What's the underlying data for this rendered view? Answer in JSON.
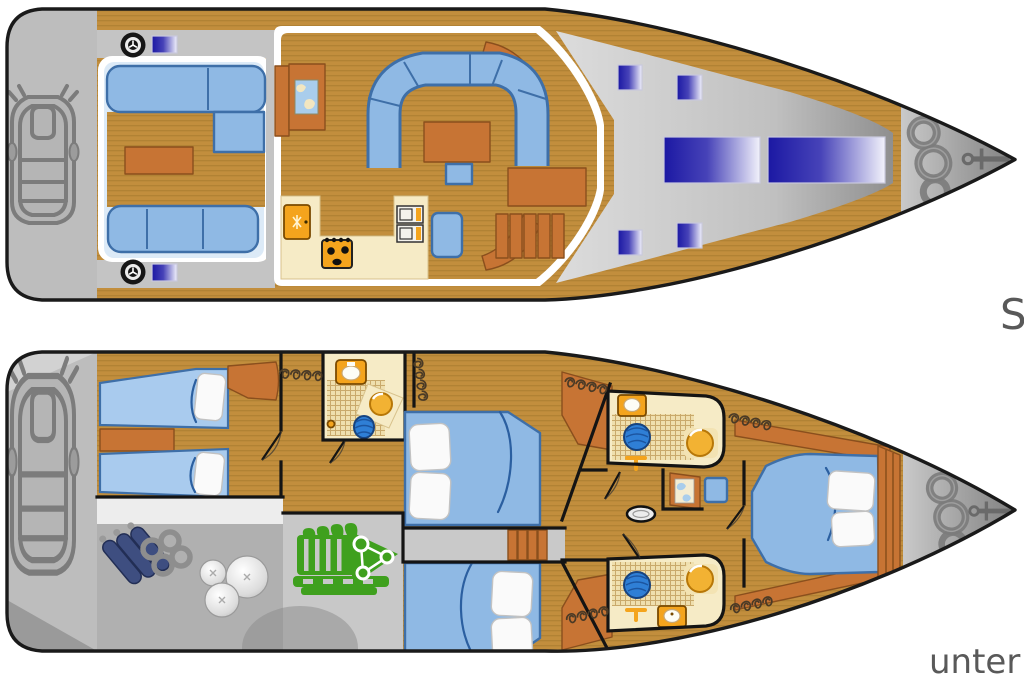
{
  "page": {
    "width": 1024,
    "height": 680,
    "background": "#FFFFFF",
    "description": "Sailing yacht layout plan: deck view (top) and below-deck cabin view (bottom)"
  },
  "labels": {
    "upper_deck": "S",
    "lower_deck": "unter D"
  },
  "palette": {
    "hull_outline": "#1A1A1A",
    "deck_wood": "#C28E3D",
    "deck_wood_stripe": "#9F762C",
    "furniture_wood": "#C77434",
    "furniture_wood_dark": "#8A4F1D",
    "cushion_blue": "#8FB9E4",
    "cushion_border": "#3E6FA8",
    "pale_blue": "#DCEAF7",
    "platform_gray": "#BDBDBD",
    "hatch_navy": "#1B18A3",
    "cream": "#F6EBC6",
    "cream_line": "#C9A96B",
    "fixture_orange": "#F4A41D",
    "engine_green": "#3FA01E",
    "fender_navy": "#3E4E80",
    "basin_blue": "#2F7FD6",
    "bowl_gold": "#F2B233",
    "label_gray": "#595959",
    "wall_black": "#141414"
  },
  "icons": {
    "anchor-icon": "anchor at bow",
    "windlass-chain-icon": "coiled anchor chain at bow",
    "winch-icon": "cockpit winch",
    "cleat-icon": "deck cleat",
    "deck-hatch-icon": "blue deck hatch / skylight",
    "dinghy-icon": "inflatable tender on stern platform",
    "stove-icon": "galley stove with burners",
    "fridge-icon": "galley fridge with snowflake",
    "sink-unit-icon": "galley sink/oven unit",
    "chart-map-icon": "navigation chart",
    "stairs-icon": "companionway steps",
    "engine-icon": "engine in engine room",
    "fender-icon": "cylindrical fender",
    "ball-fender-icon": "round fender",
    "chain-rings-icon": "chain rings",
    "toilet-icon": "marine toilet",
    "washbasin-icon": "round blue washbasin",
    "sink-bowl-icon": "golden sink bowl",
    "faucet-icon": "T-shaped faucet",
    "clothes-hanger-icon": "hanging locker hangers",
    "mast-foot-icon": "mast step",
    "bed-icon": "berth with pillows"
  }
}
